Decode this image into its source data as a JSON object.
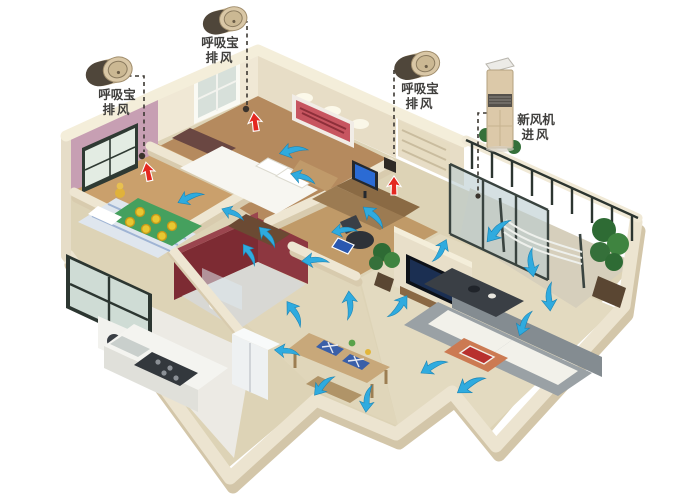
{
  "annotations": {
    "exhaust_left": {
      "line1": "呼吸宝",
      "line2": "排风"
    },
    "exhaust_top": {
      "line1": "呼吸宝",
      "line2": "排风"
    },
    "exhaust_right": {
      "line1": "呼吸宝",
      "line2": "排风"
    },
    "fresh_air": {
      "line1": "新风机",
      "line2": "进风"
    }
  },
  "devices": {
    "breather_unit_count": 3,
    "breather_icon": "gold-cylinder-exhaust-unit",
    "fresh_air_icon": "floor-standing-fresh-air-tower"
  },
  "airflow": {
    "flow_arrow_color": "#2fabdf",
    "exhaust_arrow_color": "#e42820",
    "flow_arrow_count": 22,
    "exhaust_arrow_count": 3
  },
  "colors": {
    "background": "#ffffff",
    "leader_line": "#3c3832",
    "wall": "#efe7d4",
    "floor": "#ddd3b6",
    "child_room_wall": "#c79fb3",
    "bathroom_wall": "#7d2b33",
    "device_gold": "#d9c7a6"
  }
}
